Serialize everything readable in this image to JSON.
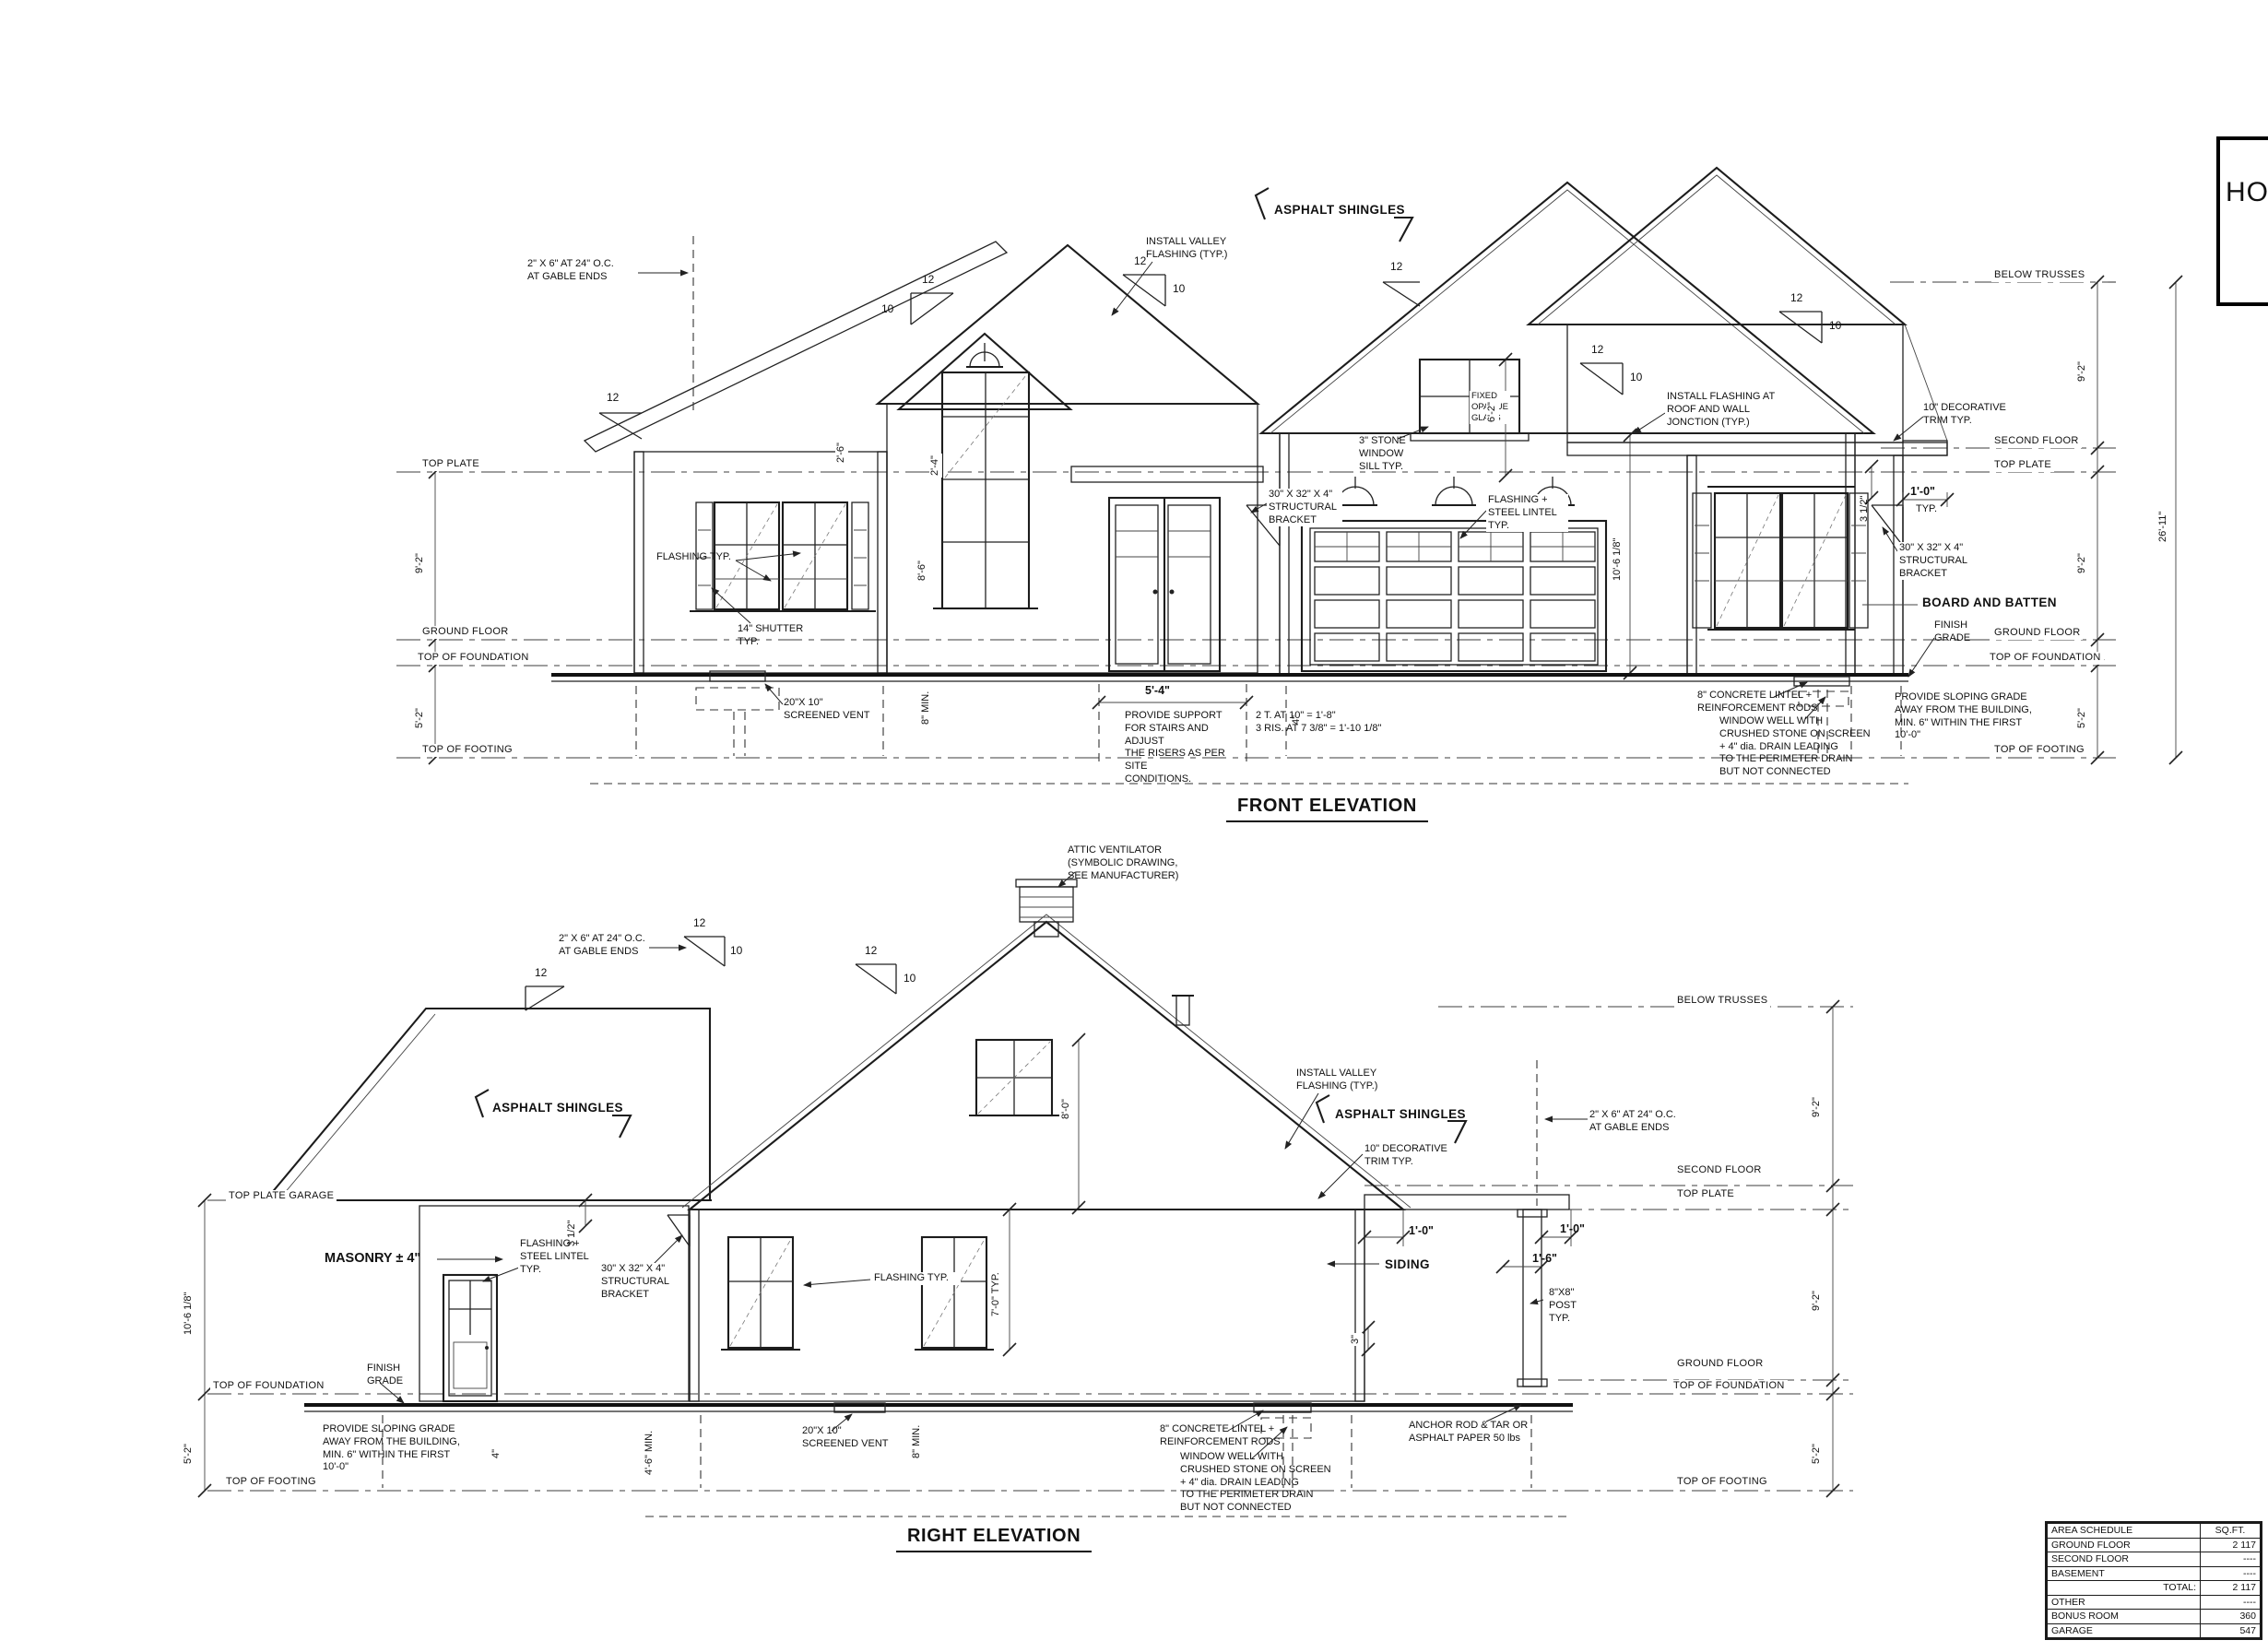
{
  "pitch": {
    "rise": "12",
    "run": "10"
  },
  "front": {
    "title": "FRONT ELEVATION",
    "ann": {
      "gable_framing": "2\" X 6\" AT 24\" O.C.\nAT GABLE ENDS",
      "valley_flashing": "INSTALL VALLEY\nFLASHING (TYP.)",
      "asphalt_shingles": "ASPHALT SHINGLES",
      "fixed_glass": "FIXED\nOPAQUE\nGLASS",
      "stone_sill": "3\" STONE WINDOW\nSILL TYP.",
      "roof_wall_flashing": "INSTALL FLASHING AT\nROOF AND WALL\nJONCTION (TYP.)",
      "decorative_trim": "10\" DECORATIVE\nTRIM TYP.",
      "bracket": "30\" X 32\" X 4\"\nSTRUCTURAL\nBRACKET",
      "lintel_flashing": "FLASHING +\nSTEEL LINTEL\nTYP.",
      "flashing": "FLASHING TYP.",
      "shutter": "14\" SHUTTER\nTYP.",
      "vent": "20\"X 10\"\nSCREENED VENT",
      "board_batten": "BOARD AND BATTEN",
      "finish_grade": "FINISH\nGRADE",
      "slope_grade": "PROVIDE SLOPING GRADE\nAWAY FROM THE BUILDING,\nMIN. 6\" WITHIN THE FIRST 10'-0\"",
      "concrete_lintel": "8\" CONCRETE LINTEL +\nREINFORCEMENT RODS",
      "window_well": "WINDOW WELL WITH\nCRUSHED STONE ON SCREEN\n+ 4\" dia. DRAIN LEADING\nTO THE PERIMETER DRAIN\nBUT NOT CONNECTED",
      "stair_note": "PROVIDE SUPPORT\nFOR STAIRS AND ADJUST\nTHE RISERS AS PER SITE\nCONDITIONS.",
      "stair_calc": "2 T. AT 10\" = 1'-8\"\n3 RIS. AT 7 3/8\" = 1'-10 1/8\""
    },
    "lv": {
      "below_trusses": "BELOW TRUSSES",
      "second_floor": "SECOND FLOOR",
      "top_plate": "TOP PLATE",
      "ground_floor": "GROUND FLOOR",
      "top_foundation": "TOP OF FOUNDATION",
      "top_footing": "TOP OF FOOTING"
    },
    "dm": {
      "h92": "9'-2\"",
      "h52": "5'-2\"",
      "h2611": "26'-11\"",
      "d312": "3 1/2\"",
      "d10": "1'-0\"",
      "typ": "TYP.",
      "d62": "6'-2\"",
      "d54": "5'-4\"",
      "d8min": "8\" MIN.",
      "d4": "4\"",
      "d86": "8'-6\"",
      "d26": "2'-6\"",
      "d24": "2'-4\"",
      "d1068": "10'-6 1/8\""
    }
  },
  "right": {
    "title": "RIGHT ELEVATION",
    "ann": {
      "attic_vent": "ATTIC VENTILATOR\n(SYMBOLIC DRAWING,\nSEE MANUFACTURER)",
      "gable_framing": "2\" X 6\" AT 24\" O.C.\nAT GABLE ENDS",
      "asphalt_shingles": "ASPHALT SHINGLES",
      "valley_flashing": "INSTALL VALLEY\nFLASHING (TYP.)",
      "decorative_trim": "10\" DECORATIVE\nTRIM TYP.",
      "masonry": "MASONRY ± 4\"",
      "lintel_flashing": "FLASHING +\nSTEEL LINTEL\nTYP.",
      "bracket": "30\" X 32\" X 4\"\nSTRUCTURAL\nBRACKET",
      "siding": "SIDING",
      "post": "8\"X8\"\nPOST\nTYP.",
      "flashing": "FLASHING TYP.",
      "anchor": "ANCHOR ROD & TAR OR\nASPHALT PAPER 50 lbs",
      "vent": "20\"X 10\"\nSCREENED VENT",
      "concrete_lintel": "8\" CONCRETE LINTEL +\nREINFORCEMENT RODS",
      "window_well": "WINDOW WELL WITH\nCRUSHED STONE ON SCREEN\n+ 4\" dia. DRAIN LEADING\nTO THE PERIMETER DRAIN\nBUT NOT CONNECTED",
      "slope_grade": "PROVIDE SLOPING GRADE\nAWAY FROM THE BUILDING,\nMIN. 6\" WITHIN THE FIRST 10'-0\"",
      "finish_grade": "FINISH\nGRADE"
    },
    "lv": {
      "top_plate_garage": "TOP PLATE GARAGE",
      "below_trusses": "BELOW TRUSSES",
      "second_floor": "SECOND FLOOR",
      "top_plate": "TOP PLATE",
      "ground_floor": "GROUND FLOOR",
      "top_foundation": "TOP OF FOUNDATION",
      "top_footing": "TOP OF FOOTING"
    },
    "dm": {
      "h1068": "10'-6 1/8\"",
      "h52": "5'-2\"",
      "h92": "9'-2\"",
      "d312": "3 1/2\"",
      "d10": "1'-0\"",
      "d16": "1'-6\"",
      "d80": "8'-0\"",
      "d70": "7'-0\" TYP.",
      "d4": "4\"",
      "d46": "4'-6\" MIN.",
      "d8min": "8\" MIN.",
      "d3": "3\""
    }
  },
  "table": {
    "headers": [
      "AREA SCHEDULE",
      "SQ.FT."
    ],
    "rows": [
      [
        "GROUND FLOOR",
        "2 117"
      ],
      [
        "SECOND FLOOR",
        "----"
      ],
      [
        "BASEMENT",
        "----"
      ],
      [
        "TOTAL:",
        "2 117"
      ],
      [
        "OTHER",
        "----"
      ],
      [
        "BONUS ROOM",
        "360"
      ],
      [
        "GARAGE",
        "547"
      ]
    ]
  },
  "title_block": {
    "partial": "HO"
  }
}
